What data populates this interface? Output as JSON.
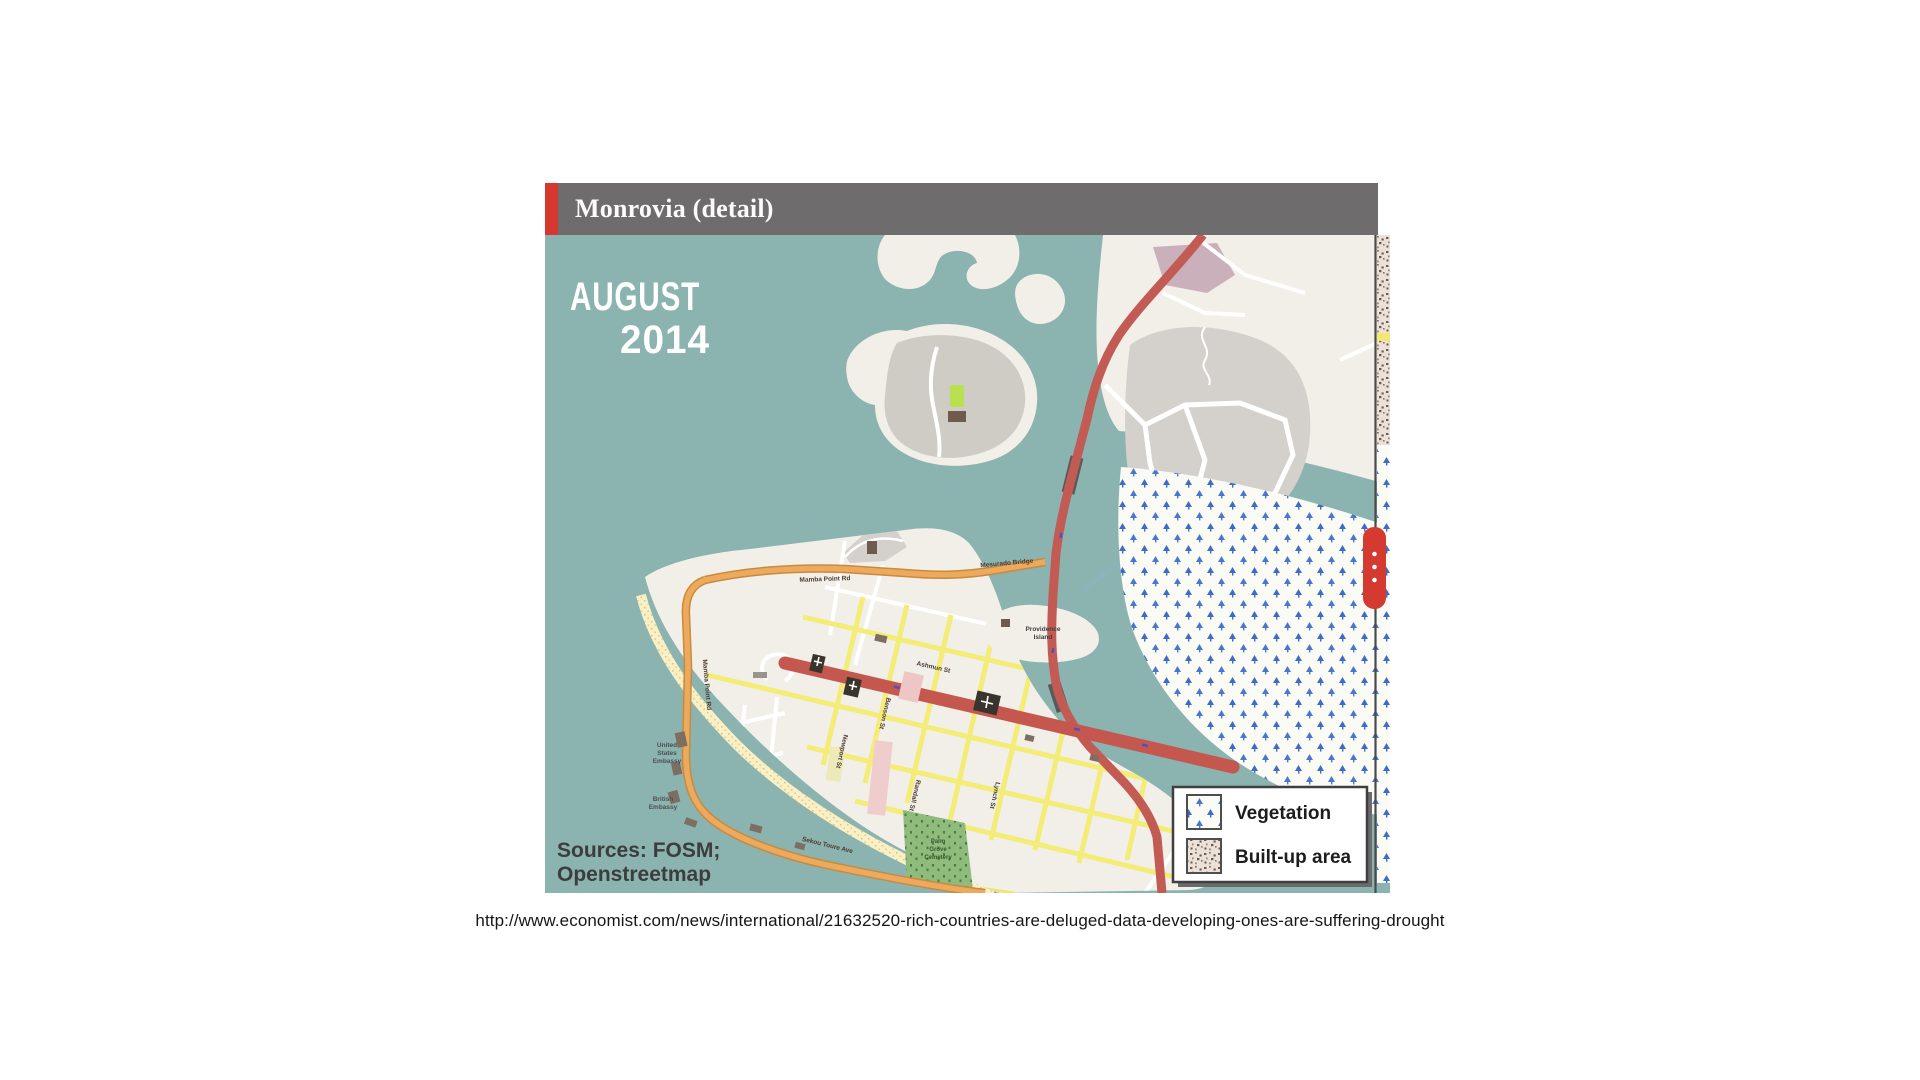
{
  "page": {
    "background": "#ffffff",
    "caption_url": "http://www.economist.com/news/international/21632520-rich-countries-are-deluged-data-developing-ones-are-suffering-drought"
  },
  "widget": {
    "title": "Monrovia (detail)",
    "colors": {
      "title_bar_bg": "#6e6c6c",
      "accent_red": "#d6382f",
      "water": "#8bb3af",
      "land": "#f2efe9",
      "builtup_gray": "#d4d1cc",
      "road_red": "#c25b53",
      "road_orange": "#ecaa5e",
      "road_yellow": "#f3ec77",
      "vegetation_blue": "#3f6bc5",
      "slider_handle_red": "#d43a30"
    },
    "period": {
      "line1": "AUGUST",
      "line2": "2014"
    },
    "sources": {
      "line1": "Sources: FOSM;",
      "line2": "Openstreetmap"
    },
    "legend": {
      "items": [
        {
          "label": "Vegetation"
        },
        {
          "label": "Built-up area"
        }
      ]
    },
    "labels": {
      "mamba_point_rd_1": "Mamba Point Rd",
      "mamba_point_rd_2": "Mamba Point Rd",
      "mesurado_bridge": "Mesurado Bridge",
      "sekou_toure_ave": "Sekou Toure Ave",
      "ashmun_st": "Ashmun St",
      "newport_st": "Newport St",
      "benson_st": "Benson St",
      "randall_st": "Randall St",
      "lynch_st": "Lynch St",
      "providence_island_line1": "Providence",
      "providence_island_line2": "Island",
      "mesurado_river": "Mesurado River",
      "us_embassy_line1": "United",
      "us_embassy_line2": "States",
      "us_embassy_line3": "Embassy",
      "british_embassy_line1": "British",
      "british_embassy_line2": "Embassy",
      "cemetery_line1": "Palm",
      "cemetery_line2": "Grove",
      "cemetery_line3": "Cemetery"
    }
  }
}
